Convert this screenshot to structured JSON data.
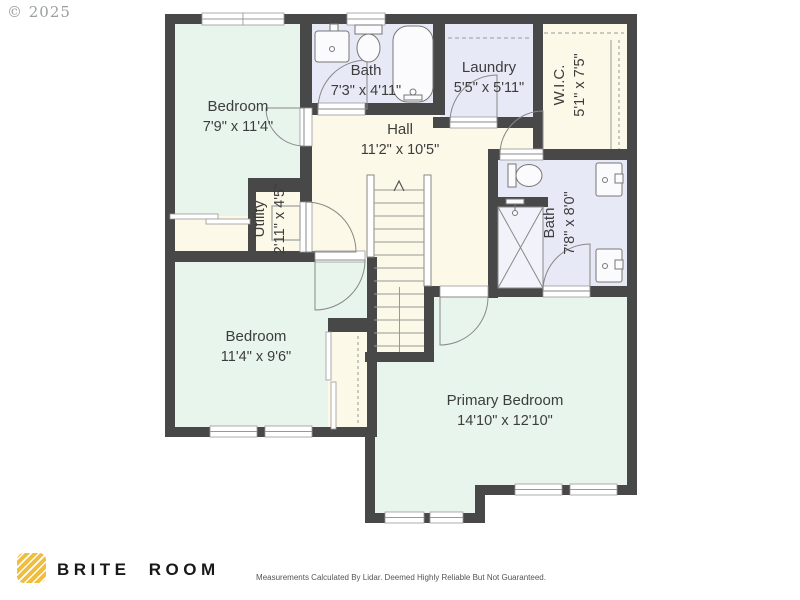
{
  "copyright": "© 2025",
  "plan": {
    "rooms": [
      {
        "id": "bedroom-1",
        "name": "Bedroom",
        "dims": "7'9\" x 11'4\""
      },
      {
        "id": "bath-top",
        "name": "Bath",
        "dims": "7'3\" x 4'11\""
      },
      {
        "id": "laundry",
        "name": "Laundry",
        "dims": "5'5\" x 5'11\""
      },
      {
        "id": "wic",
        "name": "W.I.C.",
        "dims": "5'1\" x 7'5\""
      },
      {
        "id": "hall",
        "name": "Hall",
        "dims": "11'2\" x 10'5\""
      },
      {
        "id": "utility",
        "name": "Utility",
        "dims": "2'11\" x 4'5\""
      },
      {
        "id": "bath-right",
        "name": "Bath",
        "dims": "7'8\" x 8'0\""
      },
      {
        "id": "bedroom-2",
        "name": "Bedroom",
        "dims": "11'4\" x 9'6\""
      },
      {
        "id": "primary-bedroom",
        "name": "Primary Bedroom",
        "dims": "14'10\" x 12'10\""
      }
    ],
    "colors": {
      "wall": "#484848",
      "bedroom_fill": "#e8f5ec",
      "bath_fill": "#e7eaf6",
      "hall_fill": "#fcf9e8",
      "fixture_stroke": "#777777"
    }
  },
  "footer": {
    "brand": "BRITE ROOM",
    "logo_color": "#f1bd3c",
    "disclaimer": "Measurements Calculated By Lidar. Deemed Highly Reliable But Not Guaranteed."
  }
}
